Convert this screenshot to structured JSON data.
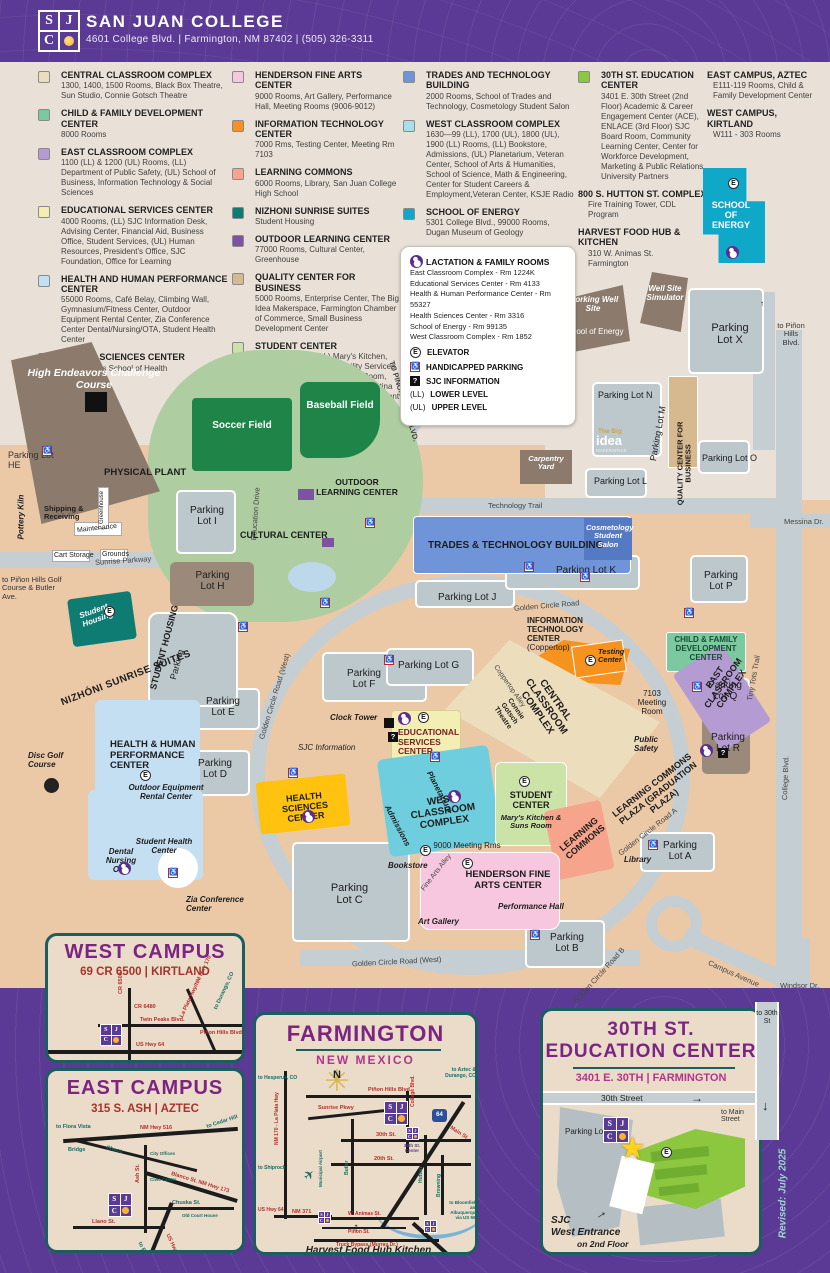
{
  "header": {
    "logo_letters": [
      "S",
      "J",
      "C"
    ],
    "title": "SAN JUAN COLLEGE",
    "address": "4601 College Blvd. | Farmington, NM 87402 | (505) 326-3311"
  },
  "colors": {
    "central": "#ecdebc",
    "child": "#7cc8a0",
    "east_classroom": "#b49bd1",
    "educational": "#f2eeb4",
    "hhpc": "#c5dff2",
    "health_sciences": "#ffc20e",
    "henderson": "#f6c7de",
    "it": "#f6921e",
    "learning": "#f6a48c",
    "nizhoni": "#0e7c72",
    "outdoor": "#7c52a1",
    "quality": "#d6b98e",
    "student": "#cbe3a6",
    "trades": "#7094d8",
    "west_classroom": "#a8dfe8",
    "energy": "#0fa8c8",
    "thirtieth": "#8dc63f",
    "field_green": "#1f8447",
    "area_green": "#aecda0",
    "brown": "#8c7b6c",
    "map_cyan": "#6fcede",
    "purple": "#5a3a94"
  },
  "legend": {
    "col1": [
      {
        "name": "CENTRAL CLASSROOM COMPLEX",
        "color": "#ecdebc",
        "desc": "1300, 1400, 1500 Rooms, Black Box Theatre, Sun Studio, Connie Gotsch Theatre"
      },
      {
        "name": "CHILD & FAMILY DEVELOPMENT CENTER",
        "color": "#7cc8a0",
        "desc": "8000 Rooms"
      },
      {
        "name": "EAST CLASSROOM COMPLEX",
        "color": "#b49bd1",
        "desc": "1100 (LL) & 1200 (UL) Rooms, (LL) Department of Public Safety, (UL) School of Business, Information Technology & Social Sciences"
      },
      {
        "name": "EDUCATIONAL SERVICES CENTER",
        "color": "#f2eeb4",
        "desc": "4000 Rooms, (LL) SJC Information Desk, Advising Center, Financial Aid, Business Office, Student Services, (UL) Human Resources, President's Office, SJC Foundation, Office for Learning"
      },
      {
        "name": "HEALTH AND HUMAN PERFORMANCE CENTER",
        "color": "#c5dff2",
        "desc": "55000 Rooms, Café Belay, Climbing Wall, Gymnasium/Fitness Center, Outdoor Equipment Rental Center, Zia Conference Center Dental/Nursing/OTA, Student Health Center"
      },
      {
        "name": "HEALTH SCIENCES CENTER",
        "color": "#ffc20e",
        "desc": "3000 Rooms School of Health Sciences"
      }
    ],
    "col2": [
      {
        "name": "HENDERSON FINE ARTS CENTER",
        "color": "#f6c7de",
        "desc": "9000 Rooms, Art Gallery, Performance Hall, Meeting Rooms (9006-9012)"
      },
      {
        "name": "INFORMATION TECHNOLOGY CENTER",
        "color": "#f6921e",
        "desc": "7000 Rms, Testing Center, Meeting Rm 7103"
      },
      {
        "name": "LEARNING COMMONS",
        "color": "#f6a48c",
        "desc": "6000 Rooms, Library, San Juan College High School"
      },
      {
        "name": "NIZHONI SUNRISE SUITES",
        "color": "#0e7c72",
        "desc": "Student Housing"
      },
      {
        "name": "OUTDOOR LEARNING CENTER",
        "color": "#7c52a1",
        "desc": "77000 Rooms, Cultural Center, Greenhouse"
      },
      {
        "name": "QUALITY CENTER FOR BUSINESS",
        "color": "#d6b98e",
        "desc": "5000 Rooms, Enterprise Center, The Big Idea Makerspace, Farmington Chamber of Commerce, Small Business Development Center"
      },
      {
        "name": "STUDENT CENTER",
        "color": "#cbe3a6",
        "desc": "1600-29 Rooms, (LL) Mary's Kitchen, Suns Room, (UL) Accessibility Services, Tutoring Center, Family Study Room, Student Suns Lounge, Herencia Latina Center, Native American Center, Student Engagement & Campus Life, Student Resource Center, Transfer Center"
      }
    ],
    "col3": [
      {
        "name": "TRADES AND TECHNOLOGY BUILDING",
        "color": "#7094d8",
        "desc": "2000 Rooms, School of Trades and Technology, Cosmetology Student Salon"
      },
      {
        "name": "WEST CLASSROOM COMPLEX",
        "color": "#a8dfe8",
        "desc": "1630—99 (LL), 1700 (UL), 1800 (UL), 1900 (LL) Rooms, (LL) Bookstore, Admissions, (UL) Planetarium, Veteran Center, School of Arts & Humanities, School of Science, Math & Engineering, Center for Student Careers & Employment,Veteran Center, KSJE Radio"
      },
      {
        "name": "SCHOOL OF ENERGY",
        "color": "#0fa8c8",
        "desc": "5301 College Blvd., 99000 Rooms, Dugan Museum of Geology"
      }
    ],
    "col4": [
      {
        "name": "30TH ST. EDUCATION CENTER",
        "color": "#8dc63f",
        "desc": "3401 E. 30th Street (2nd Floor) Academic & Career Engagement Center (ACE), ENLACE (3rd Floor) SJC Board Room, Community Learning Center, Center for Workforce Development, Marketing & Public Relations, University Partners"
      },
      {
        "name": "800 S. HUTTON ST. COMPLEX",
        "desc": "Fire Training Tower, CDL Program"
      },
      {
        "name": "HARVEST FOOD HUB & KITCHEN",
        "desc": "310 W. Animas St. Farmington"
      }
    ],
    "col5": [
      {
        "name": "EAST CAMPUS, AZTEC",
        "desc": "E111-119 Rooms, Child & Family Development Center"
      },
      {
        "name": "WEST CAMPUS, KIRTLAND",
        "desc": "W111 - 303 Rooms"
      }
    ],
    "info_box": {
      "title": "LACTATION & FAMILY ROOMS",
      "rooms": [
        "East Classroom Complex - Rm 1224K",
        "Educational Services Center - Rm 4133",
        "Health & Human Performance Center - Rm 55327",
        "Health Sciences Center - Rm 3316",
        "School of Energy - Rm 99135",
        "West Classroom Complex - Rm 1852"
      ],
      "elevator": "ELEVATOR",
      "handicapped": "HANDICAPPED PARKING",
      "sjc_info": "SJC INFORMATION",
      "ll_key": "(LL)",
      "ll": "LOWER LEVEL",
      "ul_key": "(UL)",
      "ul": "UPPER LEVEL",
      "e": "E",
      "q": "?"
    }
  },
  "map": {
    "high_endeavors": "High Endeavors Challenge Course",
    "parking_lot_he": "Parking Lot HE",
    "pottery_kiln": "Pottery Kiln",
    "physical_plant": "PHYSICAL PLANT",
    "shipping": "Shipping & Receiving",
    "maintenance": "Maintenance",
    "cart_storage": "Cart Storage",
    "greenhouse": "Greenhouse",
    "grounds": "Grounds",
    "sunrise_parkway": "Sunrise Parkway",
    "education_drive": "Education Drive",
    "to_pinon_nw": "TO PIÑON HILLS BLVD.",
    "to_golf": "to Piñon Hills Golf Course & Butler Ave.",
    "soccer": "Soccer Field",
    "baseball": "Baseball Field",
    "cultural_center": "CULTURAL CENTER",
    "outdoor_learning": "OUTDOOR LEARNING CENTER",
    "lot_i": "Parking Lot I",
    "lot_h": "Parking Lot H",
    "lot_e": "Parking Lot E",
    "lot_d": "Parking Lot D",
    "lot_c": "Parking Lot C",
    "lot_f": "Parking Lot F",
    "lot_g": "Parking Lot G",
    "lot_j": "Parking Lot J",
    "lot_k": "Parking Lot K",
    "lot_l": "Parking Lot L",
    "lot_m": "Parking Lot M",
    "lot_n": "Parking Lot N",
    "lot_o": "Parking Lot O",
    "lot_p": "Parking Lot P",
    "lot_q": "Parking Lot Q",
    "lot_r": "Parking Lot R",
    "lot_x": "Parking Lot X",
    "lot_a": "Parking Lot A",
    "lot_b": "Parking Lot B",
    "nizhoni": "NIZHÓNI SUNRISE SUITES",
    "student_housing": "Student Housing",
    "sh_parking1": "STUDENT HOUSING",
    "sh_parking2": "Parking",
    "golden_west1": "Golden Circle Road (West)",
    "golden_west2": "Golden Circle Road (West)",
    "golden": "Golden Circle Road",
    "golden_a": "Golden Circle Road A",
    "golden_b": "Golden Circle Road B",
    "coppertop_alley": "Coppertop Alley",
    "fine_arts_alley": "Fine Arts Alley",
    "technology_trail": "Technology Trail",
    "messina": "Messina Dr.",
    "tiny_tots": "Tiny Tots Trail",
    "college_blvd": "College Blvd.",
    "campus_ave": "Campus Avenue",
    "windsor": "Windsor Dr.",
    "to_30th": "to 30th St",
    "to_pinon_right": "to Piñon Hills Blvd.",
    "working_well": "Working Well Site",
    "soe_small": "School of Energy",
    "well_site": "Well Site Simulator",
    "soe_bldg": "SCHOOL OF ENERGY",
    "big_idea1": "The Big",
    "big_idea2": "idea",
    "big_idea3": "MAKERSPACE",
    "quality": "QUALITY CENTER FOR BUSINESS",
    "carpentry": "Carpentry Yard",
    "trades": "TRADES & TECHNOLOGY BUILDING",
    "cosmetology": "Cosmetology Student Salon",
    "it1": "INFORMATION",
    "it2": "TECHNOLOGY",
    "it3": "CENTER",
    "it4": "(Coppertop)",
    "testing": "Testing Center",
    "meeting_7103": "7103 Meeting Room",
    "child_family": "CHILD & FAMILY DEVELOPMENT CENTER",
    "east_classroom": "EAST CLASSROOM COMPLEX",
    "public_safety": "Public Safety",
    "central_classroom": "CENTRAL CLASSROOM COMPLEX",
    "connie": "Connie Gotsch Theatre",
    "clock_tower": "Clock Tower",
    "sjc_information": "SJC Information",
    "ed_services": "EDUCATIONAL SERVICES CENTER",
    "west_classroom": "WEST CLASSROOM COMPLEX",
    "planetarium": "Planetarium",
    "admissions": "Admissions",
    "bookstore": "Bookstore",
    "student_center": "STUDENT CENTER",
    "marys": "Mary's Kitchen & Suns Room",
    "learning_commons": "LEARNING COMMONS",
    "library": "Library",
    "lc_plaza": "LEARNING COMMONS PLAZA (GRADUATION PLAZA)",
    "henderson": "HENDERSON FINE ARTS CENTER",
    "meeting_9000": "9000 Meeting Rms",
    "performance": "Performance Hall",
    "art_gallery": "Art Gallery",
    "health_sciences": "HEALTH SCIENCES CENTER",
    "hhpc": "HEALTH & HUMAN PERFORMANCE CENTER",
    "outdoor_equip": "Outdoor Equipment Rental Center",
    "student_health": "Student Health Center",
    "dental": "Dental Nursing OTA",
    "zia": "Zia Conference Center",
    "disc_golf": "Disc Golf Course",
    "e": "E",
    "q": "?",
    "hc": "♿"
  },
  "insets": {
    "west": {
      "title": "WEST CAMPUS",
      "subtitle": "69 CR 6500 | KIRTLAND",
      "cr6500": "CR 6500",
      "cr6480": "CR 6480",
      "twin_peaks": "Twin Peaks Blvd.",
      "la_plata": "La Plata Hwy/NM Hwy 170",
      "pinon": "Piñon Hills Blvd.",
      "us64": "US Hwy 64",
      "to_durango": "to Durango, CO"
    },
    "east": {
      "title": "EAST CAMPUS",
      "subtitle": "315 S. ASH | AZTEC",
      "to_flora": "to Flora Vista",
      "hwy516": "NM Hwy 516",
      "to_cedar": "to Cedar Hill",
      "bridge": "Bridge",
      "chaco": "Chaco",
      "ash": "Ash St.",
      "city_offices": "City Offices",
      "civic": "Civic Center",
      "blanco": "Blanco St. NM Hwy 173",
      "chuska": "Chuska St.",
      "court": "Old Court House",
      "llano": "Llano St.",
      "us550": "US Hwy 550",
      "to_bloomfield": "to Bloomfield"
    },
    "farmington": {
      "title": "FARMINGTON",
      "subtitle": "NEW MEXICO",
      "north": "N",
      "to_hesperus": "to Hesperus, CO",
      "pinon_hills": "Piñon Hills Blvd.",
      "sunrise": "Sunrise Pkwy",
      "college": "College Blvd.",
      "main": "Main St.",
      "th30": "30th St.",
      "th20": "20th St.",
      "butler": "Butler",
      "hutton": "Hutton",
      "browning": "Browning",
      "municipal": "Municipal Airport",
      "la_plata": "NM 170 - La Plata Hwy",
      "to_shiprock": "to Shiprock",
      "us64": "US Hwy 64",
      "us64_shield": "64",
      "nm371": "NM 371",
      "animas": "W. Animas St.",
      "pinon_st": "Piñon St.",
      "truck": "Truck Bypass (Murray Dr.)",
      "to_aztec": "to Aztec & Durango, CO",
      "to_bloomfield": "to Bloomfield and Albuquerque via US 550",
      "center30": "30th St. Center",
      "harvest": "Harvest Food Hub Kitchen"
    },
    "thirtieth": {
      "title1": "30TH ST.",
      "title2": "EDUCATION CENTER",
      "subtitle": "3401 E. 30TH | FARMINGTON",
      "street": "30th Street",
      "to_main": "to Main Street",
      "parking": "Parking Lot",
      "entrance1": "SJC",
      "entrance2": "West Entrance",
      "entrance3": "on 2nd Floor",
      "e": "E",
      "star": "★"
    },
    "to_30th_label": "to 30th St"
  },
  "revised": "Revised: July 2025"
}
